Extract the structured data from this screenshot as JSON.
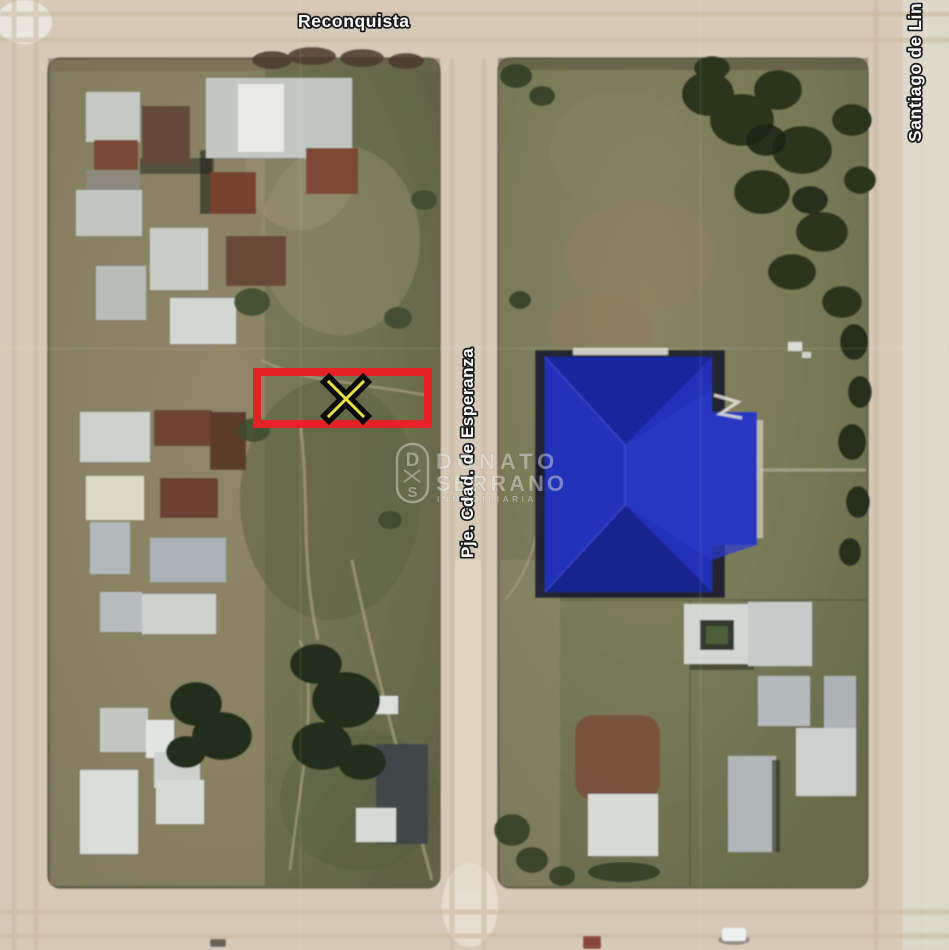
{
  "image_type": "aerial-satellite-property-listing-map",
  "streets": {
    "top_label": "Reconquista",
    "middle_label": "Pje. Cdad. de Esperanza",
    "right_label": "Santiago de Lin",
    "label_color": "#ffffff"
  },
  "property_annotation": {
    "marker_symbol": "X",
    "box_color": "#e62125",
    "marker_black": "#0a0a0a",
    "marker_yellow": "#e9e13f"
  },
  "landmarks": {
    "blue_roof_color": "#2132b8"
  },
  "watermark": {
    "logo_letter_top": "D",
    "logo_letter_bottom": "S",
    "name_line1": "DONATO",
    "name_line2": "SERRANO",
    "name_line3": "INMOBILIARIA",
    "color": "#f2f2f2"
  }
}
